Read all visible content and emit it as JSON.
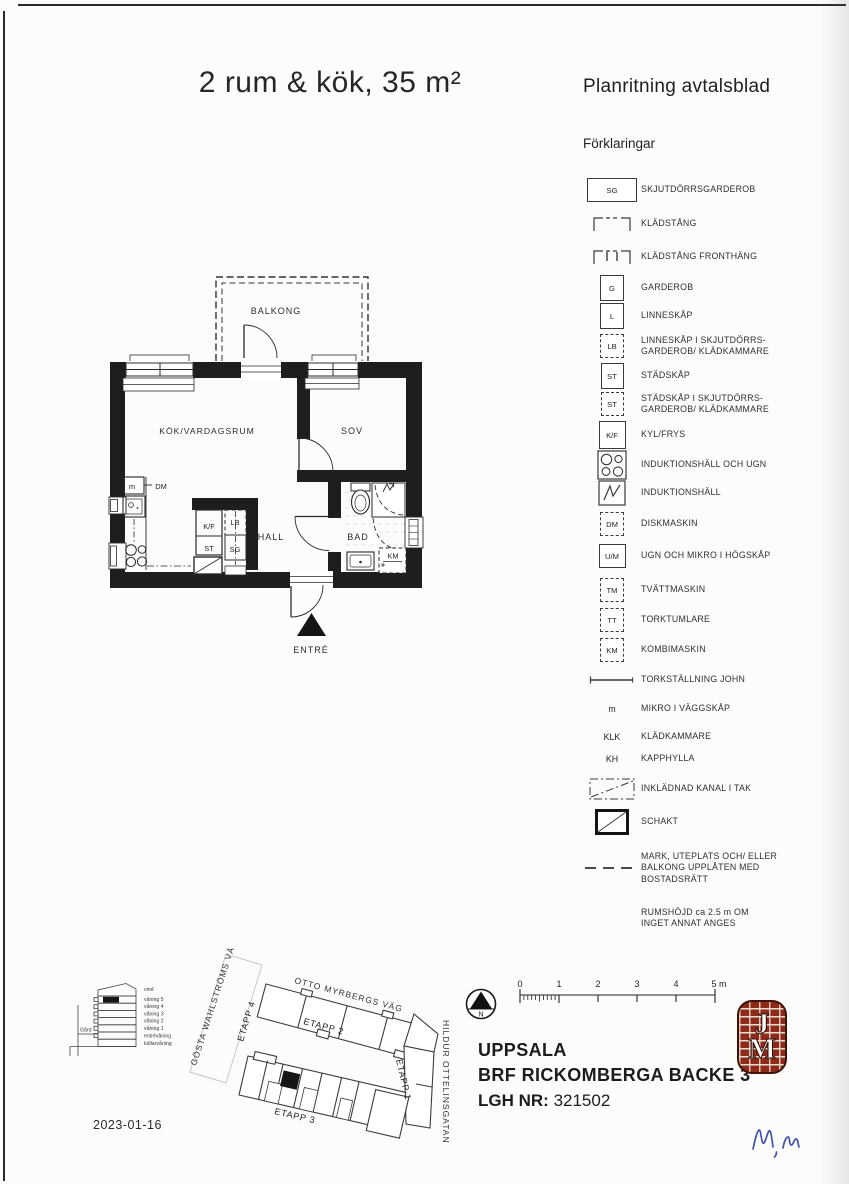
{
  "page": {
    "title": "2 rum & kök, 35 m²",
    "doc_type": "Planritning avtalsblad",
    "date": "2023-01-16"
  },
  "legend": {
    "heading": "Förklaringar",
    "items": [
      {
        "symbol": "SG",
        "label": "SKJUTDÖRRSGARDEROB"
      },
      {
        "symbol": "",
        "label": "KLÄDSTÅNG"
      },
      {
        "symbol": "",
        "label": "KLÄDSTÅNG FRONTHÄNG"
      },
      {
        "symbol": "G",
        "label": "GARDEROB"
      },
      {
        "symbol": "L",
        "label": "LINNESKÅP"
      },
      {
        "symbol": "LB",
        "label": "LINNESKÅP I SKJUTDÖRRS-\nGARDEROB/ KLÄDKAMMARE"
      },
      {
        "symbol": "ST",
        "label": "STÄDSKÅP"
      },
      {
        "symbol": "ST",
        "label": "STÄDSKÅP I SKJUTDÖRRS-\nGARDEROB/ KLÄDKAMMARE"
      },
      {
        "symbol": "K/F",
        "label": "KYL/FRYS"
      },
      {
        "symbol": "",
        "label": "INDUKTIONSHÄLL OCH UGN"
      },
      {
        "symbol": "",
        "label": "INDUKTIONSHÄLL"
      },
      {
        "symbol": "DM",
        "label": "DISKMASKIN"
      },
      {
        "symbol": "U/M",
        "label": "UGN OCH MIKRO I HÖGSKÅP"
      },
      {
        "symbol": "TM",
        "label": "TVÄTTMASKIN"
      },
      {
        "symbol": "TT",
        "label": "TORKTUMLARE"
      },
      {
        "symbol": "KM",
        "label": "KOMBIMASKIN"
      },
      {
        "symbol": "",
        "label": "TORKSTÄLLNING JOHN"
      },
      {
        "symbol": "m",
        "label": "MIKRO I VÄGGSKÅP"
      },
      {
        "symbol": "KLK",
        "label": "KLÄDKAMMARE"
      },
      {
        "symbol": "KH",
        "label": "KAPPHYLLA"
      },
      {
        "symbol": "",
        "label": "INKLÄDNAD KANAL I TAK"
      },
      {
        "symbol": "",
        "label": "SCHAKT"
      },
      {
        "symbol": "",
        "label": "MARK, UTEPLATS OCH/ ELLER\nBALKONG UPPLÅTEN MED\nBOSTADSRÄTT"
      },
      {
        "symbol": "",
        "label": "RUMSHÖJD ca 2.5 m OM\nINGET ANNAT ANGES"
      }
    ]
  },
  "floorplan": {
    "rooms": {
      "balcony": "BALKONG",
      "living": "KÖK/VARDAGSRUM",
      "bedroom": "SOV",
      "hall": "HALL",
      "bath": "BAD",
      "entrance": "ENTRÉ"
    },
    "fixtures": {
      "micro": "m",
      "dishwasher": "DM",
      "fridge": "K/F",
      "cleaning": "ST",
      "linen": "LB",
      "wardrobe": "SG",
      "combi": "KM"
    }
  },
  "siteplan": {
    "streets": {
      "gosta": "GÖSTA WAHLSTRÖMS VÄG",
      "otto": "OTTO MYRBERGS VÄG",
      "hildur": "HILDUR OTTELINSGATAN"
    },
    "stages": {
      "e1": "ETAPP 1",
      "e2": "ETAPP 2",
      "e3": "ETAPP 3",
      "e4": "ETAPP 4"
    },
    "compass_n": "N",
    "scale": {
      "ticks": [
        "0",
        "1",
        "2",
        "3",
        "4"
      ],
      "last": "5 m"
    }
  },
  "elevation": {
    "floors": [
      "vind",
      "våning 5",
      "våning 4",
      "våning 3",
      "våning 2",
      "våning 1",
      "entrévåning",
      "källarvåning"
    ],
    "yard": "Gård"
  },
  "project": {
    "city": "UPPSALA",
    "name": "BRF RICKOMBERGA BACKE 3",
    "lgh_label": "LGH NR:",
    "lgh_value": "321502",
    "logo_letters": [
      "J",
      "M"
    ]
  }
}
